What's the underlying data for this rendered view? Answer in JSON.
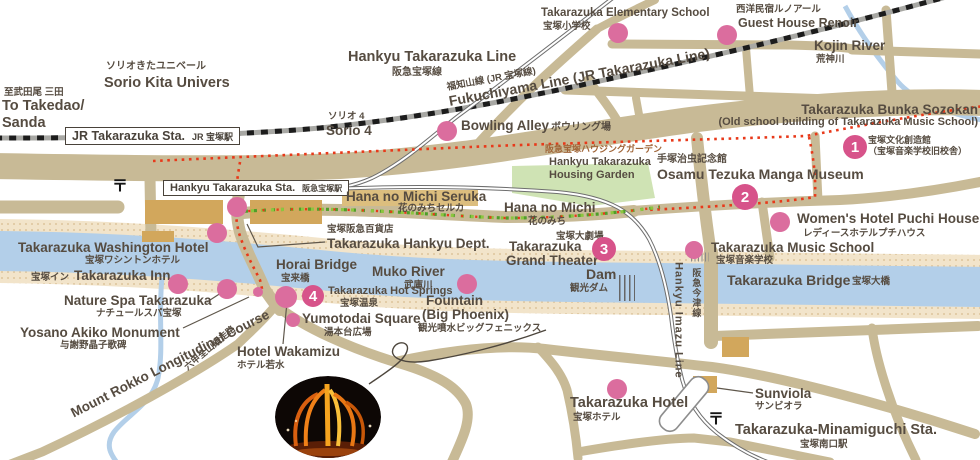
{
  "map": {
    "colors": {
      "road": "#c8ba96",
      "river": "#b3cfe9",
      "bank": "#f2e4ca",
      "bank_dot": "#ddc49c",
      "marker": "#db6d9e",
      "numbered_marker": "#d7538a",
      "trail_red": "#e8391a",
      "flower_green_dark": "#4f9e2a",
      "flower_green_light": "#8cc63f",
      "building": "#d2a75c",
      "garden": "#cfe3b4",
      "text": "#564c41",
      "rail_dark": "#6e6e6e"
    },
    "stations": {
      "jr": {
        "en": "JR Takarazuka Sta.",
        "jp": "JR 宝塚駅"
      },
      "hankyu": {
        "en": "Hankyu Takarazuka Sta.",
        "jp": "阪急宝塚駅"
      }
    },
    "post_symbol": {
      "glyph": "〒",
      "positions": [
        [
          120,
          184
        ],
        [
          716,
          417
        ]
      ]
    },
    "labels": [
      {
        "id": "to-takedao-jp",
        "text": "至武田尾 三田",
        "x": 4,
        "y": 88,
        "cls": "jp"
      },
      {
        "id": "to-takedao-en-1",
        "text": "To Takedao/",
        "x": 2,
        "y": 99,
        "cls": "en",
        "size": 14.5
      },
      {
        "id": "to-takedao-en-2",
        "text": "Sanda",
        "x": 2,
        "y": 116,
        "cls": "en",
        "size": 14.5
      },
      {
        "id": "sorio-kita-jp",
        "text": "ソリオきたユニベール",
        "x": 106,
        "y": 62,
        "cls": "jp",
        "size": 10
      },
      {
        "id": "sorio-kita-en",
        "text": "Sorio Kita Univers",
        "x": 104,
        "y": 76,
        "cls": "en",
        "size": 14.5
      },
      {
        "id": "hankyu-line-en",
        "text": "Hankyu Takarazuka Line",
        "x": 348,
        "y": 50,
        "cls": "en",
        "size": 14.5
      },
      {
        "id": "hankyu-line-jp",
        "text": "阪急宝塚線",
        "x": 392,
        "y": 68,
        "cls": "jp",
        "size": 10
      },
      {
        "id": "fukuchiyama-jp",
        "text": "福知山線 (JR 宝塚線)",
        "x": 447,
        "y": 83,
        "cls": "jp",
        "size": 9.5,
        "rot": -10.5
      },
      {
        "id": "fukuchiyama-en",
        "text": "Fukuchiyama Line (JR Takarazuka Line)",
        "x": 449,
        "y": 94,
        "cls": "en",
        "size": 14,
        "rot": -10.5
      },
      {
        "id": "elementary-en",
        "text": "Takarazuka Elementary School",
        "x": 541,
        "y": 8,
        "cls": "en",
        "size": 11.5
      },
      {
        "id": "elementary-jp",
        "text": "宝塚小学校",
        "x": 543,
        "y": 22,
        "cls": "jp"
      },
      {
        "id": "renoir-jp",
        "text": "西洋民宿ルノアール",
        "x": 736,
        "y": 5,
        "cls": "jp"
      },
      {
        "id": "renoir-en",
        "text": "Guest House Renoir",
        "x": 738,
        "y": 17,
        "cls": "en",
        "size": 12.5
      },
      {
        "id": "kojin-en",
        "text": "Kojin River",
        "x": 814,
        "y": 39,
        "cls": "en"
      },
      {
        "id": "kojin-jp",
        "text": "荒神川",
        "x": 816,
        "y": 55,
        "cls": "jp"
      },
      {
        "id": "sorio4-jp",
        "text": "ソリオ 4",
        "x": 328,
        "y": 112,
        "cls": "jp"
      },
      {
        "id": "sorio4-en",
        "text": "Sorio 4",
        "x": 326,
        "y": 124,
        "cls": "en"
      },
      {
        "id": "bowling-en",
        "text": "Bowling Alley",
        "x": 461,
        "y": 119,
        "cls": "en"
      },
      {
        "id": "bowling-jp",
        "text": "ボウリング場",
        "x": 551,
        "y": 123,
        "cls": "jp",
        "size": 10
      },
      {
        "id": "bunka-en-1",
        "text": "Takarazuka Bunka Sozokan",
        "x": 978,
        "y": 103,
        "cls": "en",
        "align": "right"
      },
      {
        "id": "bunka-en-2",
        "text": "(Old school building of Takarazuka Music School)",
        "x": 978,
        "y": 117,
        "cls": "en",
        "size": 11,
        "align": "right"
      },
      {
        "id": "bunka-jp-1",
        "text": "宝塚文化創造館",
        "x": 868,
        "y": 136,
        "cls": "jp",
        "size": 9
      },
      {
        "id": "bunka-jp-2",
        "text": "（宝塚音楽学校旧校舎）",
        "x": 868,
        "y": 147,
        "cls": "jp",
        "size": 9
      },
      {
        "id": "housing-garden-jp",
        "text": "阪急宝塚ハウジングガーデン",
        "x": 545,
        "y": 145,
        "cls": "jp",
        "size": 9,
        "color": "#a06538"
      },
      {
        "id": "housing-garden-en-1",
        "text": "Hankyu Takarazuka",
        "x": 549,
        "y": 157,
        "cls": "en",
        "size": 11
      },
      {
        "id": "housing-garden-en-2",
        "text": "Housing Garden",
        "x": 549,
        "y": 170,
        "cls": "en",
        "size": 11
      },
      {
        "id": "tezuka-jp",
        "text": "手塚治虫記念館",
        "x": 657,
        "y": 155,
        "cls": "jp",
        "size": 10
      },
      {
        "id": "tezuka-en",
        "text": "Osamu Tezuka Manga Museum",
        "x": 657,
        "y": 167,
        "cls": "en",
        "size": 14
      },
      {
        "id": "seruka-en",
        "text": "Hana no Michi Seruka",
        "x": 346,
        "y": 190,
        "cls": "en"
      },
      {
        "id": "seruka-jp",
        "text": "花のみちセルカ",
        "x": 398,
        "y": 204,
        "cls": "jp"
      },
      {
        "id": "hanamichi-en",
        "text": "Hana no Michi",
        "x": 504,
        "y": 201,
        "cls": "en"
      },
      {
        "id": "hanamichi-jp",
        "text": "花のみち",
        "x": 528,
        "y": 217,
        "cls": "jp"
      },
      {
        "id": "womens-en",
        "text": "Women's Hotel Puchi House",
        "x": 797,
        "y": 212,
        "cls": "en"
      },
      {
        "id": "womens-jp",
        "text": "レディースホテルプチハウス",
        "x": 803,
        "y": 229,
        "cls": "jp"
      },
      {
        "id": "music-school-en",
        "text": "Takarazuka Music School",
        "x": 711,
        "y": 241,
        "cls": "en"
      },
      {
        "id": "music-school-jp",
        "text": "宝塚音楽学校",
        "x": 716,
        "y": 256,
        "cls": "jp"
      },
      {
        "id": "dept-jp",
        "text": "宝塚阪急百貨店",
        "x": 327,
        "y": 225,
        "cls": "jp"
      },
      {
        "id": "dept-en",
        "text": "Takarazuka Hankyu Dept.",
        "x": 327,
        "y": 237,
        "cls": "en"
      },
      {
        "id": "washington-en",
        "text": "Takarazuka Washington Hotel",
        "x": 18,
        "y": 241,
        "cls": "en"
      },
      {
        "id": "washington-jp",
        "text": "宝塚ワシントンホテル",
        "x": 85,
        "y": 256,
        "cls": "jp"
      },
      {
        "id": "gtheater-jp",
        "text": "宝塚大劇場",
        "x": 556,
        "y": 232,
        "cls": "jp"
      },
      {
        "id": "gtheater-en-1",
        "text": "Takarazuka",
        "x": 509,
        "y": 240,
        "cls": "en"
      },
      {
        "id": "gtheater-en-2",
        "text": "Grand Theater",
        "x": 506,
        "y": 254,
        "cls": "en"
      },
      {
        "id": "horai-en",
        "text": "Horai Bridge",
        "x": 276,
        "y": 258,
        "cls": "en"
      },
      {
        "id": "horai-jp",
        "text": "宝来橋",
        "x": 281,
        "y": 274,
        "cls": "jp"
      },
      {
        "id": "muko-en",
        "text": "Muko River",
        "x": 372,
        "y": 265,
        "cls": "en"
      },
      {
        "id": "muko-jp",
        "text": "武庫川",
        "x": 404,
        "y": 281,
        "cls": "jp"
      },
      {
        "id": "inn-jp",
        "text": "宝塚イン",
        "x": 31,
        "y": 273,
        "cls": "jp"
      },
      {
        "id": "inn-en",
        "text": "Takarazuka Inn",
        "x": 74,
        "y": 269,
        "cls": "en"
      },
      {
        "id": "nature-en",
        "text": "Nature Spa Takarazuka",
        "x": 64,
        "y": 294,
        "cls": "en"
      },
      {
        "id": "nature-jp",
        "text": "ナチュールスパ宝塚",
        "x": 96,
        "y": 309,
        "cls": "jp"
      },
      {
        "id": "yosano-en",
        "text": "Yosano Akiko Monument",
        "x": 20,
        "y": 326,
        "cls": "en"
      },
      {
        "id": "yosano-jp",
        "text": "与謝野晶子歌碑",
        "x": 60,
        "y": 341,
        "cls": "jp"
      },
      {
        "id": "rokko-en",
        "text": "Mount Rokko Longitudinal Course",
        "x": 72,
        "y": 407,
        "cls": "en",
        "rot": -27
      },
      {
        "id": "rokko-jp",
        "text": "六甲全山縦走路",
        "x": 186,
        "y": 364,
        "cls": "jp",
        "size": 9,
        "rot": -40
      },
      {
        "id": "wakamizu-en",
        "text": "Hotel Wakamizu",
        "x": 237,
        "y": 345,
        "cls": "en"
      },
      {
        "id": "wakamizu-jp",
        "text": "ホテル若水",
        "x": 237,
        "y": 361,
        "cls": "jp"
      },
      {
        "id": "hotspring-en",
        "text": "Takarazuka Hot Springs",
        "x": 328,
        "y": 286,
        "cls": "en",
        "size": 11
      },
      {
        "id": "hotspring-jp",
        "text": "宝塚温泉",
        "x": 340,
        "y": 299,
        "cls": "jp"
      },
      {
        "id": "yumotodai-en",
        "text": "Yumotodai Square",
        "x": 302,
        "y": 312,
        "cls": "en"
      },
      {
        "id": "yumotodai-jp",
        "text": "湯本台広場",
        "x": 324,
        "y": 328,
        "cls": "jp"
      },
      {
        "id": "fountain-en-1",
        "text": "Fountain",
        "x": 426,
        "y": 294,
        "cls": "en"
      },
      {
        "id": "fountain-en-2",
        "text": "(Big Phoenix)",
        "x": 422,
        "y": 308,
        "cls": "en"
      },
      {
        "id": "fountain-jp",
        "text": "観光噴水ビッグフェニックス",
        "x": 418,
        "y": 324,
        "cls": "jp"
      },
      {
        "id": "dam-en",
        "text": "Dam",
        "x": 586,
        "y": 267,
        "cls": "en",
        "size": 14
      },
      {
        "id": "dam-jp",
        "text": "観光ダム",
        "x": 570,
        "y": 284,
        "cls": "jp"
      },
      {
        "id": "bridge-en",
        "text": "Takarazuka Bridge",
        "x": 727,
        "y": 273,
        "cls": "en",
        "size": 14
      },
      {
        "id": "bridge-jp",
        "text": "宝塚大橋",
        "x": 852,
        "y": 277,
        "cls": "jp"
      },
      {
        "id": "imazu-en",
        "text": "Hankyu Imazu Line",
        "x": 672,
        "y": 262,
        "cls": "ven"
      },
      {
        "id": "imazu-jp",
        "text": "阪急今津線",
        "x": 691,
        "y": 268,
        "cls": "vjp"
      },
      {
        "id": "sunviola-en",
        "text": "Sunviola",
        "x": 755,
        "y": 387,
        "cls": "en"
      },
      {
        "id": "sunviola-jp",
        "text": "サンビオラ",
        "x": 755,
        "y": 402,
        "cls": "jp"
      },
      {
        "id": "thotel-en",
        "text": "Takarazuka Hotel",
        "x": 570,
        "y": 396,
        "cls": "en",
        "size": 14.5
      },
      {
        "id": "thotel-jp",
        "text": "宝塚ホテル",
        "x": 573,
        "y": 413,
        "cls": "jp"
      },
      {
        "id": "minami-en",
        "text": "Takarazuka-Minamiguchi Sta.",
        "x": 735,
        "y": 423,
        "cls": "en",
        "size": 14.5
      },
      {
        "id": "minami-jp",
        "text": "宝塚南口駅",
        "x": 800,
        "y": 440,
        "cls": "jp"
      }
    ],
    "markers": [
      [
        618,
        33,
        10
      ],
      [
        727,
        35,
        10
      ],
      [
        447,
        131,
        10
      ],
      [
        237,
        207,
        10
      ],
      [
        217,
        233,
        10
      ],
      [
        780,
        222,
        10
      ],
      [
        694,
        250,
        9
      ],
      [
        467,
        284,
        10
      ],
      [
        178,
        284,
        10
      ],
      [
        227,
        289,
        10
      ],
      [
        258,
        292,
        5
      ],
      [
        286,
        297,
        11
      ],
      [
        293,
        320,
        7
      ],
      [
        617,
        389,
        10
      ]
    ],
    "numbered_markers": [
      {
        "n": "1",
        "x": 855,
        "y": 147,
        "r": 12
      },
      {
        "n": "2",
        "x": 745,
        "y": 197,
        "r": 13
      },
      {
        "n": "3",
        "x": 604,
        "y": 249,
        "r": 12
      },
      {
        "n": "4",
        "x": 313,
        "y": 296,
        "r": 11
      }
    ]
  }
}
